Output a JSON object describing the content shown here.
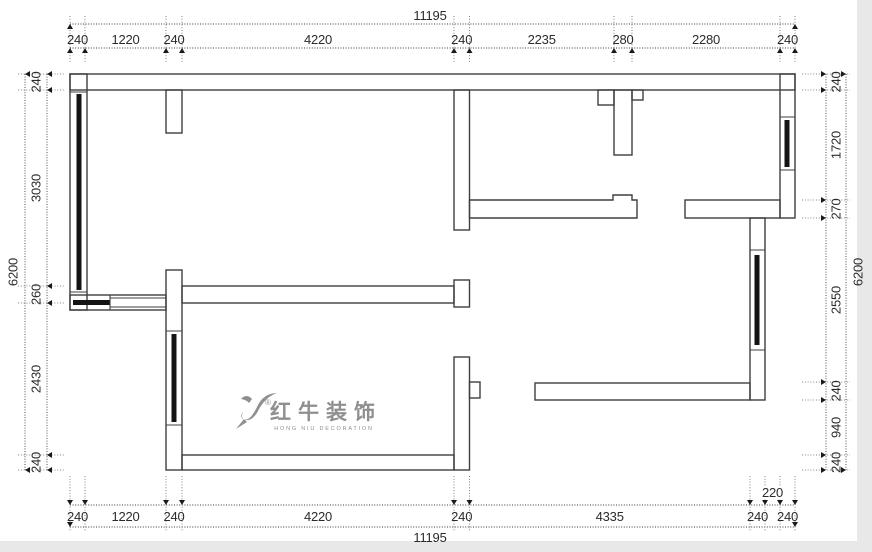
{
  "dimensions": {
    "top": {
      "total": "11195",
      "segments": [
        "240",
        "1220",
        "240",
        "4220",
        "240",
        "2235",
        "280",
        "2280",
        "240"
      ]
    },
    "bottom": {
      "total": "11195",
      "segments": [
        "240",
        "1220",
        "240",
        "4220",
        "240",
        "4335",
        "240",
        "240"
      ],
      "raised_segment": "220"
    },
    "left": {
      "total": "6200",
      "segments": [
        "240",
        "3030",
        "260",
        "2430",
        "240"
      ]
    },
    "right": {
      "total": "6200",
      "segments": [
        "240",
        "1720",
        "270",
        "2550",
        "240",
        "940",
        "240"
      ]
    }
  },
  "watermark": {
    "registered": "®",
    "brand": "红牛装饰",
    "subtitle": "HONG NIU DECORATION"
  },
  "colors": {
    "paper": "#ffffff",
    "wall_line": "#3f3f3f",
    "glazing": "#141414",
    "dimension": "#3a3a3a",
    "watermark": "#8f8f8f",
    "edge": "#e8e8e8"
  }
}
